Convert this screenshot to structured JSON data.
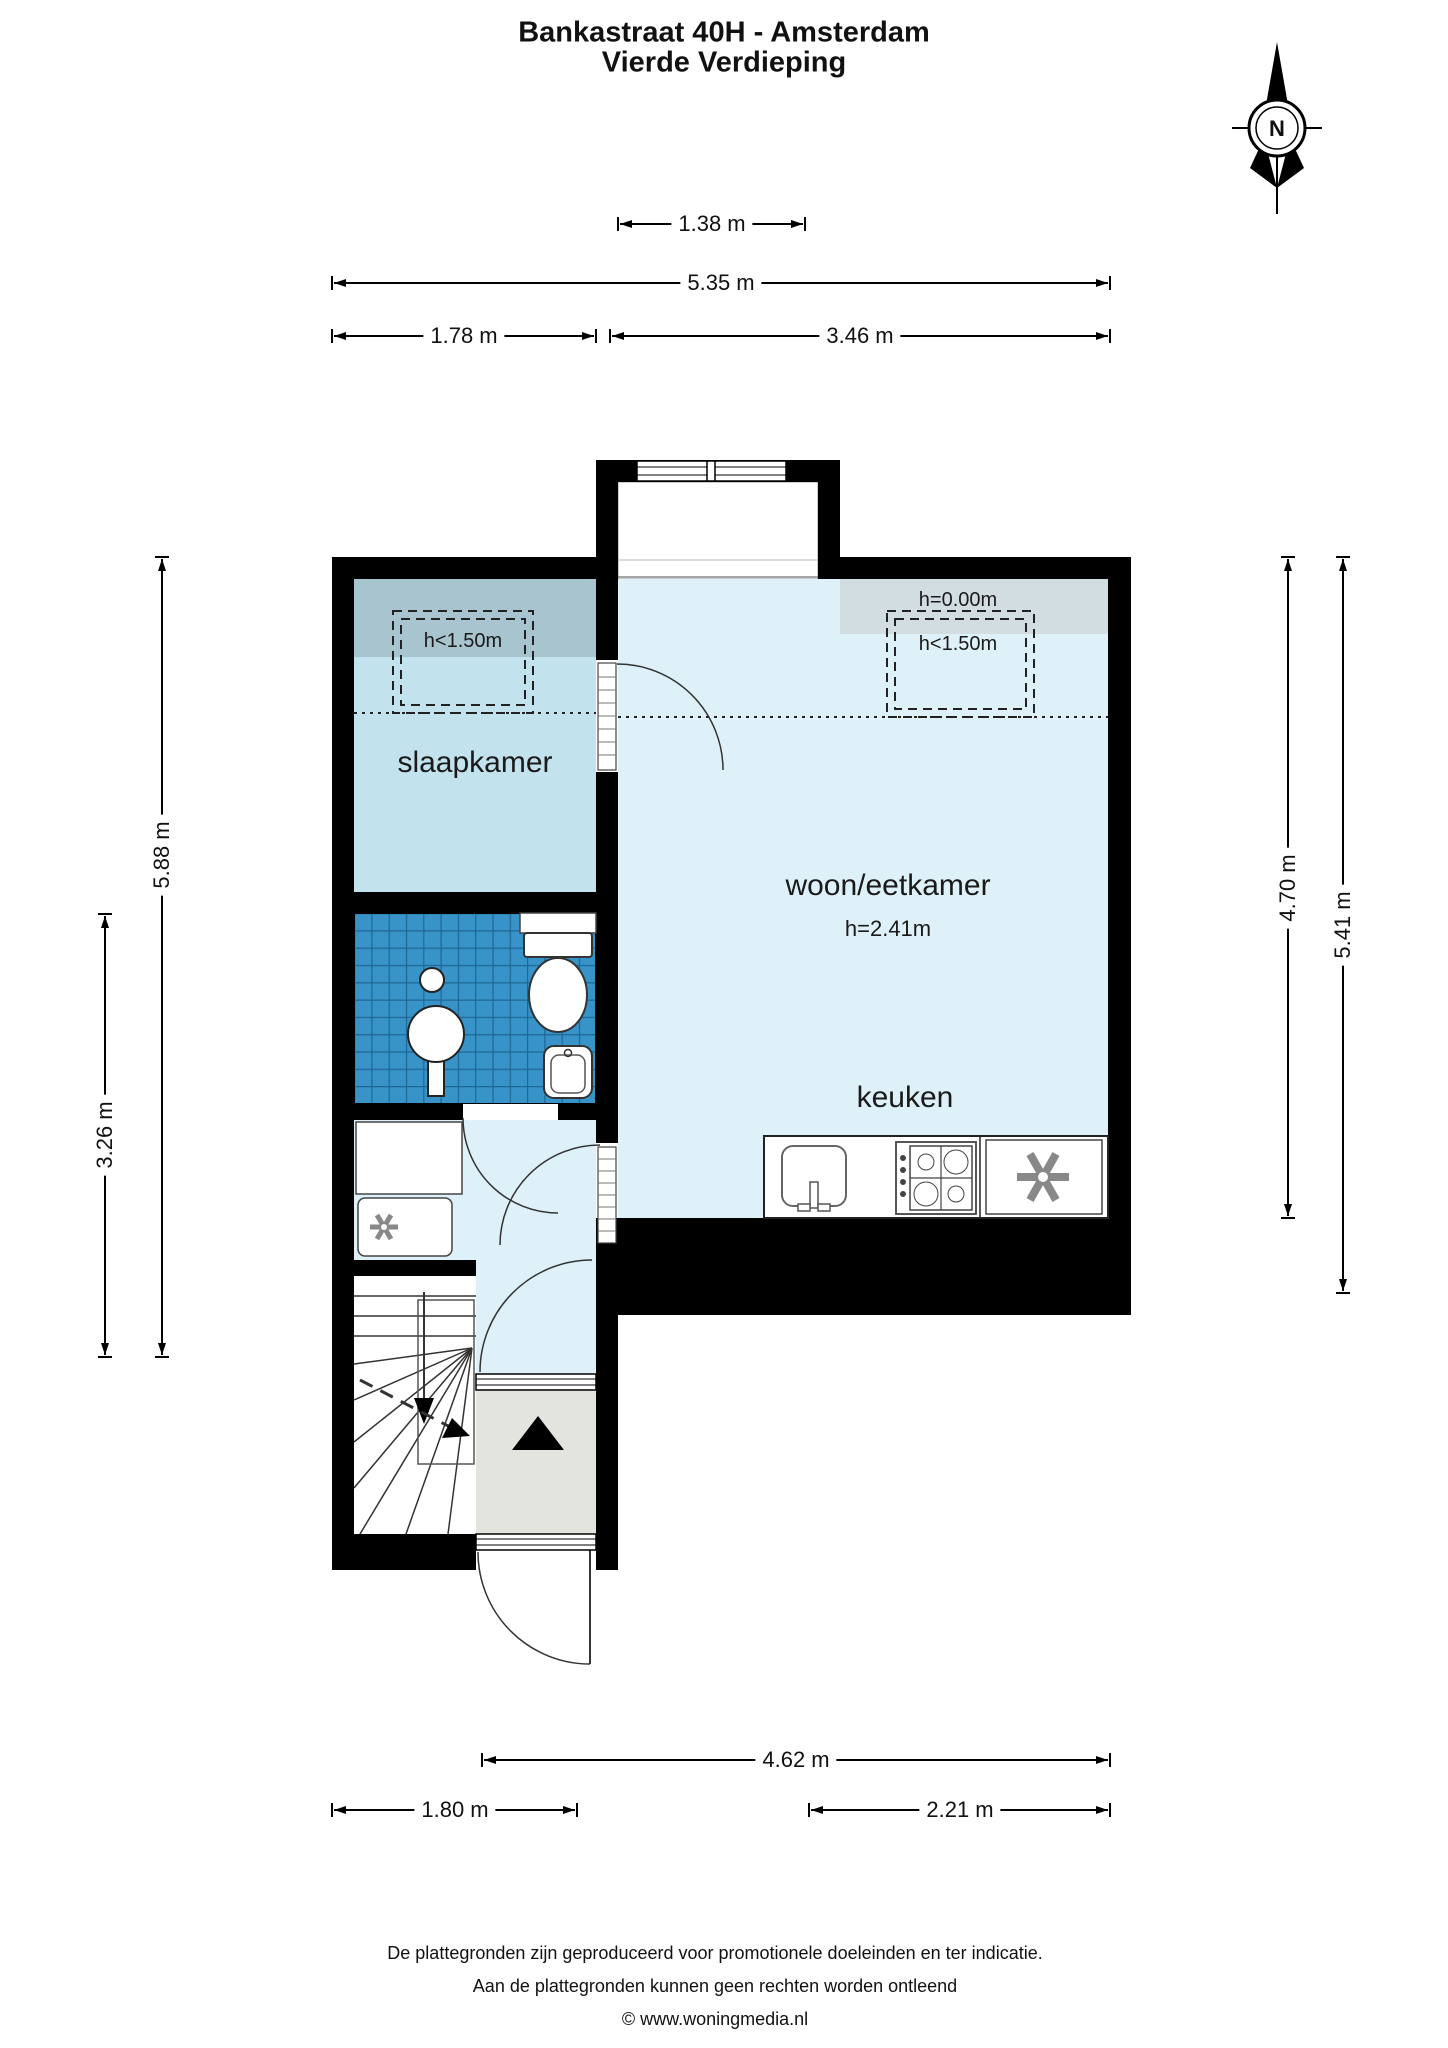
{
  "header": {
    "title_line1": "Bankastraat 40H - Amsterdam",
    "title_line2": "Vierde Verdieping"
  },
  "compass": {
    "label": "N"
  },
  "floorplan": {
    "rooms": {
      "bedroom_label": "slaapkamer",
      "living_label": "woon/eetkamer",
      "living_ceiling_height": "h=2.41m",
      "kitchen_label": "keuken"
    },
    "height_zones": {
      "zero_height_label": "h=0.00m",
      "bedroom_low_ceiling_label": "h<1.50m",
      "living_low_ceiling_label": "h<1.50m"
    },
    "colors": {
      "wall": "#000000",
      "bedroom_floor": "#c2e2ed",
      "bedroom_low_band": "#a8c4ce",
      "living_floor": "#def0f8",
      "living_low_band": "#d2dde2",
      "bathroom_tile": "#3793c8",
      "bathroom_tile_line": "#1f6795",
      "vestibule_floor": "#e4e4df"
    }
  },
  "dimensions": {
    "top": [
      {
        "label": "1.38 m"
      },
      {
        "label": "5.35 m"
      },
      {
        "label": "1.78 m"
      },
      {
        "label": "3.46 m"
      }
    ],
    "left": [
      {
        "label": "5.88 m"
      },
      {
        "label": "3.26 m"
      }
    ],
    "right": [
      {
        "label": "4.70 m"
      },
      {
        "label": "5.41 m"
      }
    ],
    "bottom": [
      {
        "label": "4.62 m"
      },
      {
        "label": "1.80 m"
      },
      {
        "label": "2.21 m"
      }
    ]
  },
  "footer": {
    "line1": "De plattegronden zijn geproduceerd voor promotionele doeleinden en ter indicatie.",
    "line2": "Aan de plattegronden kunnen geen rechten worden ontleend",
    "line3": "© www.woningmedia.nl"
  }
}
